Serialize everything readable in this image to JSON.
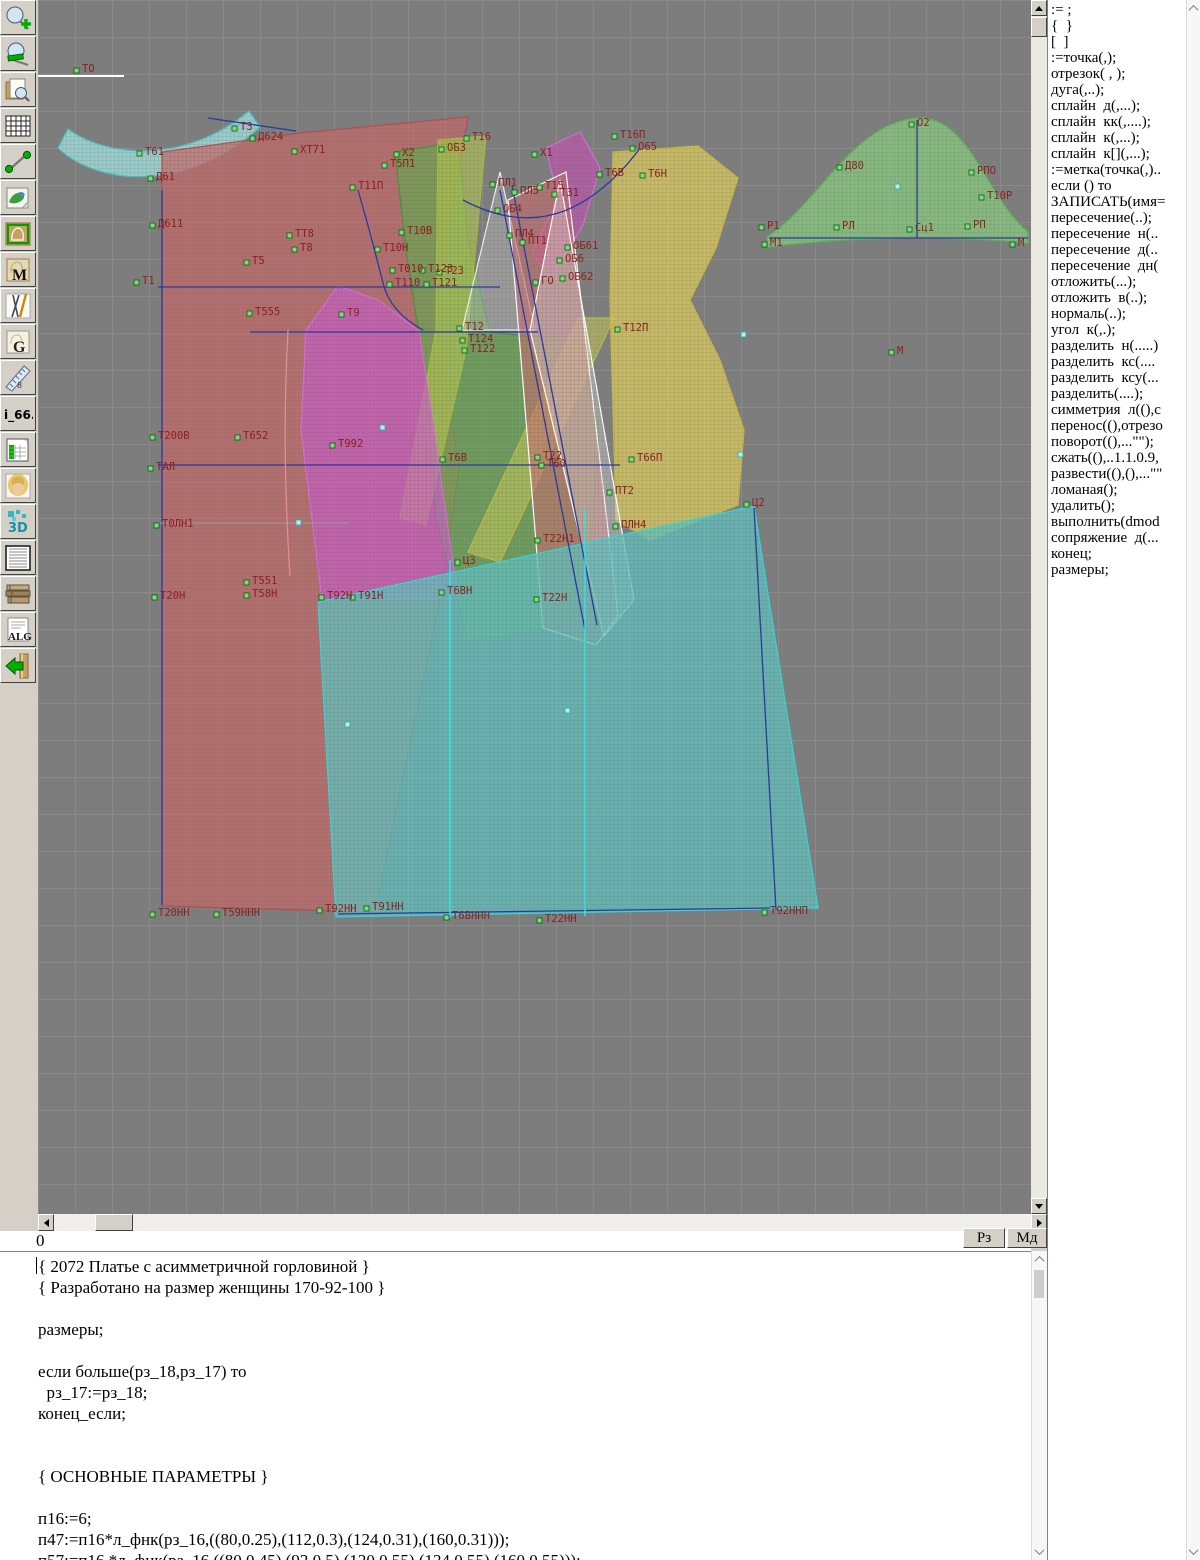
{
  "window": {
    "title": "pattern CAD workspace"
  },
  "statusbar": {
    "h_value": "0",
    "rz_label": "Рз",
    "md_label": "Мд"
  },
  "toolbar": {
    "buttons": [
      {
        "name": "zoom-in-button",
        "icon": "magnifier-plus-icon",
        "label": ""
      },
      {
        "name": "zoom-out-button",
        "icon": "magnifier-minus-icon",
        "label": ""
      },
      {
        "name": "sheet-preview-button",
        "icon": "sheet-magnifier-icon",
        "label": ""
      },
      {
        "name": "grid-button",
        "icon": "grid-icon",
        "label": ""
      },
      {
        "name": "measure-button",
        "icon": "measure-icon",
        "label": ""
      },
      {
        "name": "image-button",
        "icon": "map-icon",
        "label": ""
      },
      {
        "name": "pattern-frame-button",
        "icon": "pattern-frame-icon",
        "label": ""
      },
      {
        "name": "pattern-m-button",
        "icon": "pattern-m-icon",
        "label": "M"
      },
      {
        "name": "drafting-tools-button",
        "icon": "drafting-tools-icon",
        "label": ""
      },
      {
        "name": "pattern-g-button",
        "icon": "pattern-g-icon",
        "label": "G"
      },
      {
        "name": "ruler-button",
        "icon": "ruler-icon",
        "label": "8"
      },
      {
        "name": "i66-button",
        "icon": "i66-icon",
        "label": "i_66."
      },
      {
        "name": "spreadsheet-button",
        "icon": "spreadsheet-icon",
        "label": ""
      },
      {
        "name": "model-photo-button",
        "icon": "model-photo-icon",
        "label": ""
      },
      {
        "name": "threed-button",
        "icon": "threed-icon",
        "label": "3D"
      },
      {
        "name": "text-list-button",
        "icon": "text-list-icon",
        "label": ""
      },
      {
        "name": "books-button",
        "icon": "books-icon",
        "label": ""
      },
      {
        "name": "alg-button",
        "icon": "alg-icon",
        "label": "ALG"
      },
      {
        "name": "exit-button",
        "icon": "exit-icon",
        "label": ""
      }
    ]
  },
  "commands": [
    ":= ;",
    "{  }",
    "[  ]",
    ":=точка(,);",
    "отрезок( , );",
    "дуга(,..);",
    "сплайн  д(,...);",
    "сплайн  кк(,....);",
    "сплайн  к(,...);",
    "сплайн  к[](,...);",
    ":=метка(точка(,)..",
    "если () то",
    "ЗАПИСАТЬ(имя=",
    "пересечение(..);",
    "пересечение  н(..",
    "пересечение  д(..",
    "пересечение  дн(",
    "отложить(...);",
    "отложить  в(..);",
    "нормаль(..);",
    "угол  к(,.);",
    "разделить  н(.....)",
    "разделить  кс(....",
    "разделить  ксу(...",
    "разделить(....);",
    "симметрия  л((),с",
    "перенос((),отрезо",
    "поворот((),...\"\");",
    "сжать((),..1.1.0.9,",
    "развести((),(),...\"\"",
    "ломаная();",
    "удалить();",
    "выполнить(dmod",
    "сопряжение  д(...",
    "конец;",
    "размеры;"
  ],
  "editor": {
    "lines": [
      "{ 2072 Платье с асимметричной горловиной }",
      "{ Разработано на размер женщины 170-92-100 }",
      "",
      "размеры;",
      "",
      "если больше(рз_18,рз_17) то",
      "  рз_17:=рз_18;",
      "конец_если;",
      "",
      "",
      "{ ОСНОВНЫЕ ПАРАМЕТРЫ }",
      "",
      "п16:=6;",
      "п47:=п16*л_фнк(рз_16,((80,0.25),(112,0.3),(124,0.31),(160,0.31)));",
      "п57:=п16 *л_фнк(рз_16,((80,0.45),(92,0.5),(120,0.55),(124,0.55),(160,0.55)));"
    ]
  },
  "canvas": {
    "background": "#7d7d7d",
    "grid_color": "#8a8a8a",
    "grid_step": 37,
    "label_color": "#8b1f1f",
    "pieces": [
      {
        "name": "collar",
        "fill": "#9fd8d8",
        "stroke": "#49c3c3",
        "opacity": 0.85,
        "path": "M 20,148 C 60,186 150,193 222,127 L 211,111 C 145,166 66,156 30,129 Z"
      },
      {
        "name": "front-panel",
        "fill": "#c86868",
        "stroke": "#b05050",
        "opacity": 0.72,
        "path": "M 124,152 L 262,133 L 430,117 L 414,210 L 400,290 L 408,390 L 421,470 L 402,600 L 337,912 L 124,906 Z"
      },
      {
        "name": "neck-sickle",
        "fill": "#cc50b8",
        "stroke": "#d070d0",
        "opacity": 0.6,
        "path": "M 508,148 L 542,132 L 562,168 L 545,225 L 512,278 L 494,252 L 520,200 Z"
      },
      {
        "name": "back-panel",
        "fill": "#6aa850",
        "stroke": "#4a9040",
        "opacity": 0.7,
        "path": "M 357,152 L 420,142 L 430,240 L 452,332 L 540,342 L 561,430 L 552,560 L 530,626 L 430,641 L 398,520 L 388,380 L 368,250 Z"
      },
      {
        "name": "strap-left",
        "fill": "#b8cc50",
        "stroke": "#a8bc40",
        "opacity": 0.6,
        "path": "M 400,140 L 448,136 L 428,350 L 388,525 L 362,518 L 398,330 Z"
      },
      {
        "name": "strap-right",
        "fill": "#c8cc58",
        "stroke": "#b8bc48",
        "opacity": 0.55,
        "path": "M 540,318 L 576,318 L 462,562 L 430,552 Z"
      },
      {
        "name": "side-back-yellow",
        "fill": "#d8c860",
        "stroke": "#c8b840",
        "opacity": 0.8,
        "path": "M 575,152 L 660,146 L 700,178 L 678,248 L 652,300 L 682,360 L 706,430 L 700,505 L 612,540 L 578,520 L 572,300 Z"
      },
      {
        "name": "facing-triangle",
        "fill": "#dddddd",
        "stroke": "#eeeeee",
        "opacity": 0.3,
        "path": "M 424,330 L 462,172 L 497,330 Z"
      },
      {
        "name": "sash",
        "fill": "#cc7070",
        "stroke": "#ffffff",
        "opacity": 0.6,
        "path": "M 470,200 L 528,172 L 580,615 L 558,645 L 505,628 Z"
      },
      {
        "name": "sash-lining",
        "fill": "#e8e8e8",
        "stroke": "#ffffff",
        "opacity": 0.35,
        "path": "M 492,330 L 522,180 L 596,600 L 566,636 Z"
      },
      {
        "name": "side-panel-magenta",
        "fill": "#cc5ecc",
        "stroke": "#d070d0",
        "opacity": 0.65,
        "path": "M 300,286 L 340,300 L 381,331 L 396,430 L 420,598 L 284,600 L 263,430 L 268,330 Z"
      },
      {
        "name": "skirt",
        "fill": "#62c0bc",
        "stroke": "#35d8d8",
        "opacity": 0.78,
        "path": "M 280,602 L 716,506 L 780,908 L 298,917 Z"
      },
      {
        "name": "sleeve-cap",
        "fill": "#88c880",
        "stroke": "#58b858",
        "opacity": 0.8,
        "path": "M 729,237 C 780,205 815,122 880,118 C 932,116 948,198 990,232 L 990,243 C 900,234 800,238 730,247 Z"
      }
    ],
    "lines": [
      {
        "c": "#ffffff",
        "w": 2,
        "d": "M 0,76 L 86,76"
      },
      {
        "c": "#2b3a9e",
        "w": 1.3,
        "d": "M 170,118 L 258,131"
      },
      {
        "c": "#2b3a9e",
        "w": 1.3,
        "d": "M 120,287 L 462,287"
      },
      {
        "c": "#2b3a9e",
        "w": 1.3,
        "d": "M 212,332 L 500,332"
      },
      {
        "c": "#2b3a9e",
        "w": 1.3,
        "d": "M 120,465 L 582,465"
      },
      {
        "c": "#2b3a9e",
        "w": 1.3,
        "d": "M 124,190 L 124,905"
      },
      {
        "c": "#2b3a9e",
        "w": 1.3,
        "d": "M 320,190 Q 333,235 345,283 Q 352,312 385,330"
      },
      {
        "c": "#2b3a9e",
        "w": 1.3,
        "d": "M 425,200 Q 500,240 562,190 Q 585,172 602,148"
      },
      {
        "c": "#2b3a9e",
        "w": 1.3,
        "d": "M 462,190 L 547,630"
      },
      {
        "c": "#2b3a9e",
        "w": 1.3,
        "d": "M 474,185 L 559,625"
      },
      {
        "c": "#2b3a9e",
        "w": 1.3,
        "d": "M 731,238 L 990,238"
      },
      {
        "c": "#2b3a9e",
        "w": 1.3,
        "d": "M 879,120 L 879,238"
      },
      {
        "c": "#2b3a9e",
        "w": 1.3,
        "d": "M 716,508 L 738,910"
      },
      {
        "c": "#2b3a9e",
        "w": 1.3,
        "d": "M 300,914 L 732,908"
      },
      {
        "c": "#9a9a9a",
        "w": 1,
        "d": "M 120,523 L 310,523"
      },
      {
        "c": "#e89090",
        "w": 1.2,
        "d": "M 250,330 C 245,420 247,500 252,576"
      },
      {
        "c": "#35e0e0",
        "w": 1.5,
        "d": "M 547,508 L 547,916"
      },
      {
        "c": "#35e0e0",
        "w": 1.5,
        "d": "M 412,560 L 412,918"
      }
    ],
    "labels": [
      {
        "t": "ТО",
        "x": 44,
        "y": 72
      },
      {
        "t": "Т3",
        "x": 202,
        "y": 130
      },
      {
        "t": "Д624",
        "x": 220,
        "y": 140
      },
      {
        "t": "Т61",
        "x": 107,
        "y": 155
      },
      {
        "t": "ХТ71",
        "x": 262,
        "y": 153
      },
      {
        "t": "Д61",
        "x": 118,
        "y": 180
      },
      {
        "t": "Д611",
        "x": 120,
        "y": 227
      },
      {
        "t": "Х2",
        "x": 364,
        "y": 156
      },
      {
        "t": "Т5П1",
        "x": 352,
        "y": 167
      },
      {
        "t": "ОБ3",
        "x": 409,
        "y": 151
      },
      {
        "t": "Т16",
        "x": 434,
        "y": 140
      },
      {
        "t": "Х1",
        "x": 502,
        "y": 156
      },
      {
        "t": "Т16П",
        "x": 582,
        "y": 138
      },
      {
        "t": "О65",
        "x": 600,
        "y": 150
      },
      {
        "t": "Т6В",
        "x": 567,
        "y": 176
      },
      {
        "t": "Т6Н",
        "x": 610,
        "y": 177
      },
      {
        "t": "Т11П",
        "x": 320,
        "y": 189
      },
      {
        "t": "ПЛ1",
        "x": 460,
        "y": 186
      },
      {
        "t": "ПЛ5",
        "x": 482,
        "y": 194
      },
      {
        "t": "Т15",
        "x": 507,
        "y": 189
      },
      {
        "t": "Т31",
        "x": 522,
        "y": 196
      },
      {
        "t": "ОБ4",
        "x": 465,
        "y": 212
      },
      {
        "t": "Т10В",
        "x": 369,
        "y": 234
      },
      {
        "t": "ТТ8",
        "x": 257,
        "y": 237
      },
      {
        "t": "Т8",
        "x": 262,
        "y": 251
      },
      {
        "t": "ПЛ4",
        "x": 477,
        "y": 237
      },
      {
        "t": "ПТ1",
        "x": 490,
        "y": 244
      },
      {
        "t": "ОБ61",
        "x": 535,
        "y": 249
      },
      {
        "t": "ОБ6",
        "x": 527,
        "y": 262
      },
      {
        "t": "Т10Н",
        "x": 345,
        "y": 251
      },
      {
        "t": "Т5",
        "x": 214,
        "y": 264
      },
      {
        "t": "ОБ62",
        "x": 530,
        "y": 280
      },
      {
        "t": "Т010",
        "x": 360,
        "y": 272
      },
      {
        "t": "Т123",
        "x": 390,
        "y": 272
      },
      {
        "t": "ГО",
        "x": 503,
        "y": 284
      },
      {
        "t": "Т1",
        "x": 104,
        "y": 284
      },
      {
        "t": "Т110",
        "x": 357,
        "y": 286
      },
      {
        "t": "Т121",
        "x": 394,
        "y": 286
      },
      {
        "t": "Т23",
        "x": 407,
        "y": 274
      },
      {
        "t": "Т555",
        "x": 217,
        "y": 315
      },
      {
        "t": "Т9",
        "x": 309,
        "y": 316
      },
      {
        "t": "Т12",
        "x": 427,
        "y": 330
      },
      {
        "t": "Т124",
        "x": 430,
        "y": 342
      },
      {
        "t": "Т122",
        "x": 432,
        "y": 352
      },
      {
        "t": "Т12П",
        "x": 585,
        "y": 331
      },
      {
        "t": "М",
        "x": 859,
        "y": 354
      },
      {
        "t": "Т200В",
        "x": 120,
        "y": 439
      },
      {
        "t": "Т652",
        "x": 205,
        "y": 439
      },
      {
        "t": "Т992",
        "x": 300,
        "y": 447
      },
      {
        "t": "ТАЛ",
        "x": 118,
        "y": 470
      },
      {
        "t": "Т6В",
        "x": 410,
        "y": 461
      },
      {
        "t": "Т22",
        "x": 505,
        "y": 459
      },
      {
        "t": "Т60",
        "x": 509,
        "y": 467
      },
      {
        "t": "Т66П",
        "x": 599,
        "y": 461
      },
      {
        "t": "ПТ2",
        "x": 577,
        "y": 494
      },
      {
        "t": "Ц2",
        "x": 714,
        "y": 506
      },
      {
        "t": "Т0ЛН1",
        "x": 124,
        "y": 527
      },
      {
        "t": "ПЛН4",
        "x": 583,
        "y": 528
      },
      {
        "t": "Т22Н1",
        "x": 505,
        "y": 542
      },
      {
        "t": "Ц3",
        "x": 425,
        "y": 564
      },
      {
        "t": "Т551",
        "x": 214,
        "y": 584
      },
      {
        "t": "Т58Н",
        "x": 214,
        "y": 597
      },
      {
        "t": "Т20Н",
        "x": 122,
        "y": 599
      },
      {
        "t": "Т92Н",
        "x": 289,
        "y": 599
      },
      {
        "t": "Т91Н",
        "x": 320,
        "y": 599
      },
      {
        "t": "Т6ВН",
        "x": 409,
        "y": 594
      },
      {
        "t": "Т22Н",
        "x": 504,
        "y": 601
      },
      {
        "t": "Т20НН",
        "x": 120,
        "y": 916
      },
      {
        "t": "Т59ННН",
        "x": 184,
        "y": 916
      },
      {
        "t": "Т92НН",
        "x": 287,
        "y": 912
      },
      {
        "t": "Т91НН",
        "x": 334,
        "y": 910
      },
      {
        "t": "Т6ВННН",
        "x": 414,
        "y": 919
      },
      {
        "t": "Т22НН",
        "x": 507,
        "y": 922
      },
      {
        "t": "Т92ННП",
        "x": 732,
        "y": 914
      },
      {
        "t": "О2",
        "x": 879,
        "y": 126
      },
      {
        "t": "Д80",
        "x": 807,
        "y": 169
      },
      {
        "t": "РПО",
        "x": 939,
        "y": 174
      },
      {
        "t": "Т10Р",
        "x": 949,
        "y": 199
      },
      {
        "t": "Р1",
        "x": 729,
        "y": 229
      },
      {
        "t": "М1",
        "x": 732,
        "y": 246
      },
      {
        "t": "РЛ",
        "x": 804,
        "y": 229
      },
      {
        "t": "Сц1",
        "x": 877,
        "y": 231
      },
      {
        "t": "РП",
        "x": 935,
        "y": 228
      },
      {
        "t": "М",
        "x": 980,
        "y": 246
      }
    ],
    "cyan_markers": [
      [
        258,
        520
      ],
      [
        307,
        722
      ],
      [
        527,
        708
      ],
      [
        700,
        452
      ],
      [
        857,
        184
      ],
      [
        342,
        425
      ],
      [
        703,
        332
      ]
    ]
  }
}
